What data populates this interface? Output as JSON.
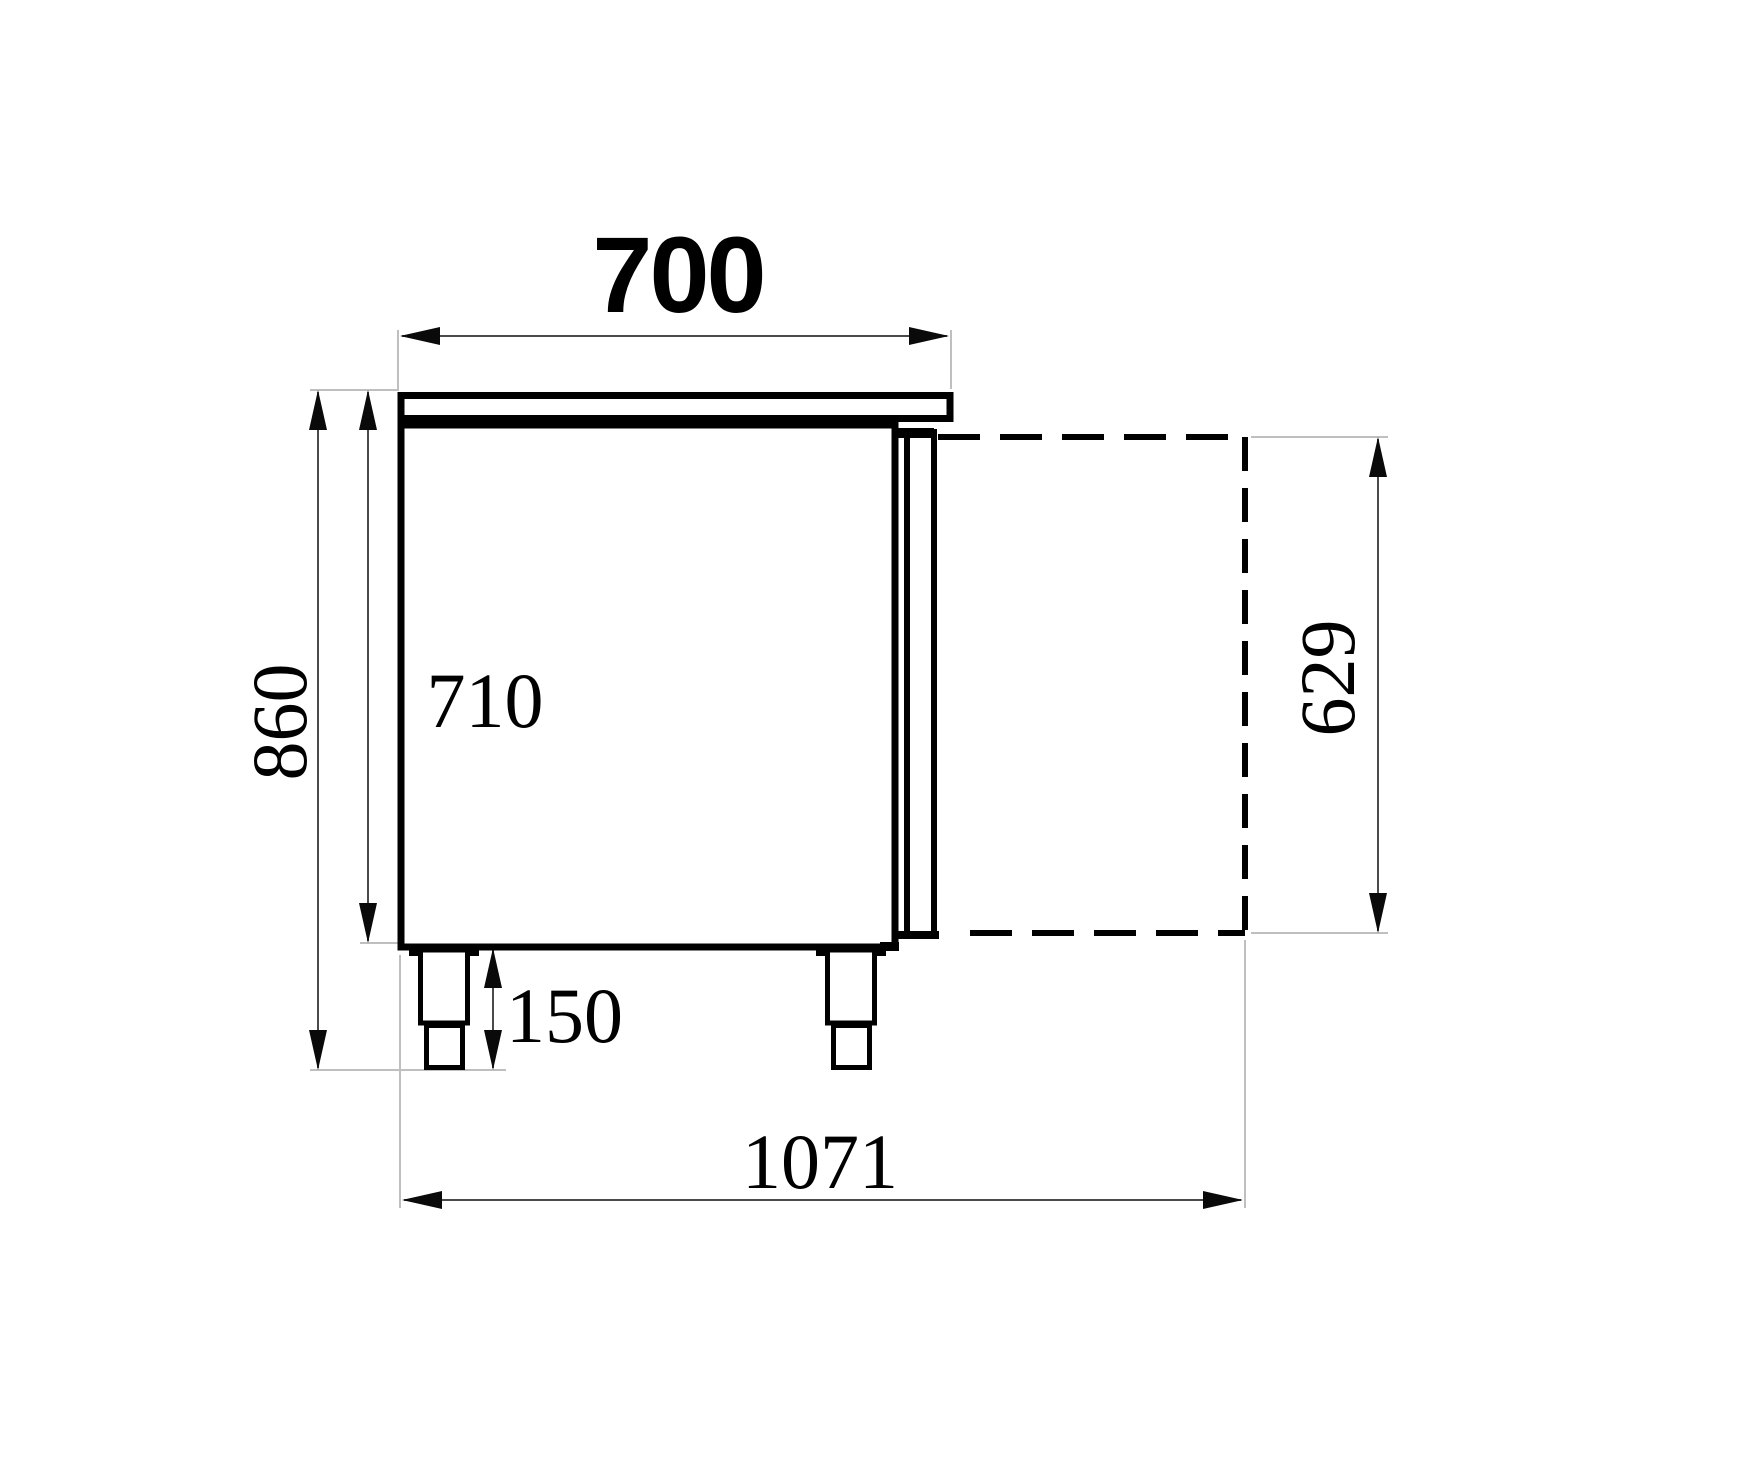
{
  "drawing": {
    "description": "Side-view technical dimension drawing of a refrigerated counter cabinet with worktop, open-door projection and legs",
    "labels": {
      "width_top": "700",
      "height_overall": "860",
      "height_body": "710",
      "height_leg": "150",
      "depth_overall": "1071",
      "door_height": "629"
    },
    "colors": {
      "background": "#ffffff",
      "object_line": "#000000",
      "dimension_line": "#4a4a4a",
      "extension_line": "#bfbfbf",
      "arrow": "#0a0a0a",
      "text": "#000000"
    }
  }
}
